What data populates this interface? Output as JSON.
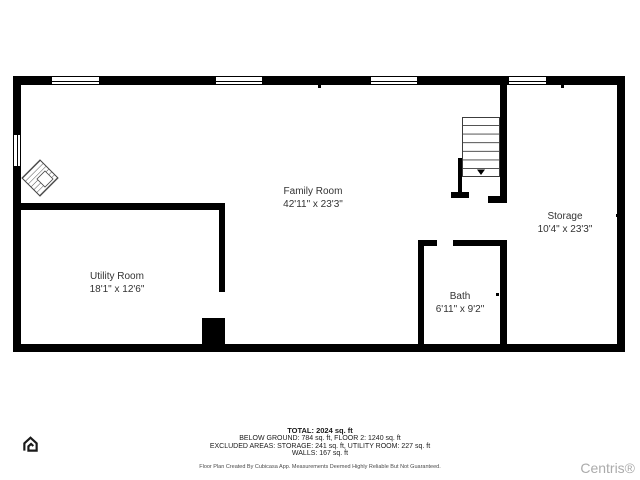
{
  "floor_plan": {
    "rooms": [
      {
        "name": "Family Room",
        "dimensions": "42'11\" x 23'3\""
      },
      {
        "name": "Utility Room",
        "dimensions": "18'1\" x 12'6\""
      },
      {
        "name": "Bath",
        "dimensions": "6'11\" x 9'2\""
      },
      {
        "name": "Storage",
        "dimensions": "10'4\" x 23'3\""
      }
    ],
    "features": [
      "stairs-down",
      "fireplace",
      "windows"
    ]
  },
  "footer": {
    "total": "TOTAL: 2024 sq. ft",
    "breakdown": "BELOW GROUND: 784 sq. ft, FLOOR 2: 1240 sq. ft",
    "excluded": "EXCLUDED AREAS: STORAGE: 241 sq. ft, UTILITY ROOM: 227 sq. ft",
    "walls": "WALLS: 167 sq. ft",
    "disclaimer": "Floor Plan Created By Cubicasa App. Measurements Deemed Highly Reliable But Not Guaranteed."
  },
  "branding": {
    "watermark": "Centris®",
    "logo_icon": "cubicasa-house-icon"
  },
  "colors": {
    "wall": "#000000",
    "label_text": "#333333",
    "watermark_text": "#ababab"
  }
}
